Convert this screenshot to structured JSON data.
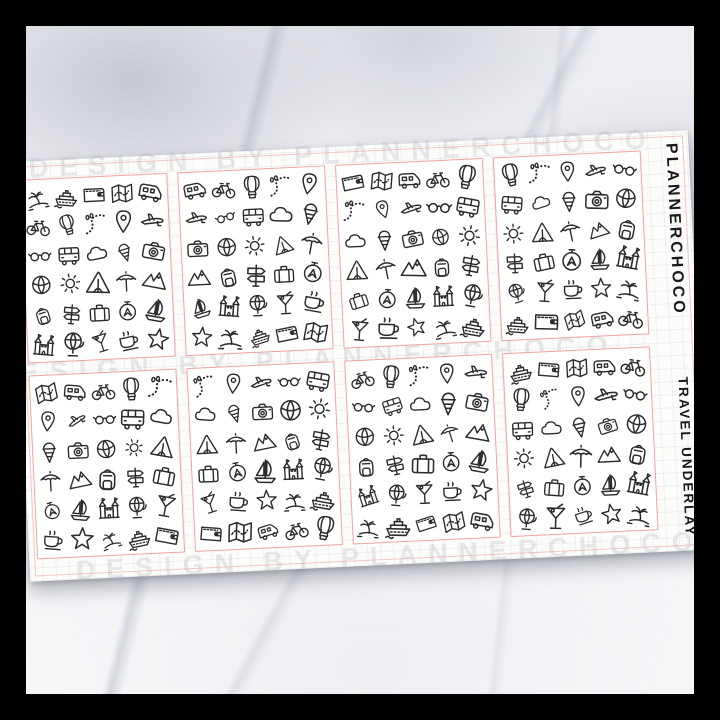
{
  "photo": {
    "surface": "white-marble",
    "frame_color": "#000000"
  },
  "sheet": {
    "brand_label": "PLANNERCHOCO",
    "product_label": "TRAVEL UNDERLAY",
    "watermark_text": "DESIGN BY PLANNERCHOCO",
    "rows": 2,
    "cols": 4,
    "icons_per_square": 30,
    "square_offsets": [
      0,
      4,
      2,
      6,
      3,
      7,
      5,
      1
    ],
    "colors": {
      "cut_line": "#f0a49e",
      "doodle_ink": "#2b2b2b",
      "sheet_background": "#fcfcfb"
    }
  },
  "icons": [
    "palm-island",
    "cruise-ship",
    "wallet",
    "map",
    "camper-van",
    "bicycle",
    "hot-air-balloon",
    "footprints",
    "location-pin",
    "airplane",
    "sunglasses",
    "bus",
    "cloud",
    "ice-cream",
    "camera",
    "beach-ball",
    "sun",
    "tent",
    "beach-umbrella",
    "mountains",
    "backpack",
    "signpost",
    "suitcase",
    "compass",
    "sailboat",
    "castle",
    "globe",
    "cocktail",
    "coffee-cup",
    "starfish"
  ]
}
